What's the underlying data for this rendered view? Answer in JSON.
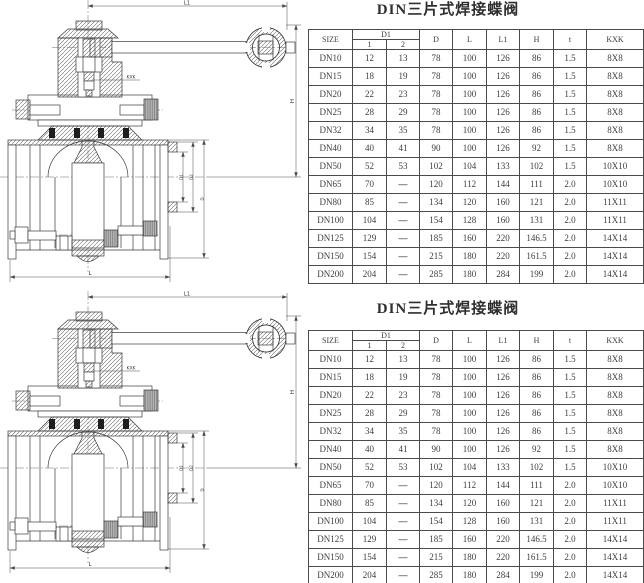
{
  "page": {
    "title_top": "DIN三片式焊接蝶阀",
    "title_bottom": "DIN三片式焊接蝶阀"
  },
  "table": {
    "headers": {
      "size": "SIZE",
      "d1": "D1",
      "d1_sub1": "1",
      "d1_sub2": "2",
      "d": "D",
      "l": "L",
      "l1": "L1",
      "h": "H",
      "t": "t",
      "kxk": "KXK"
    },
    "rows": [
      [
        "DN10",
        "12",
        "13",
        "78",
        "100",
        "126",
        "86",
        "1.5",
        "8X8"
      ],
      [
        "DN15",
        "18",
        "19",
        "78",
        "100",
        "126",
        "86",
        "1.5",
        "8X8"
      ],
      [
        "DN20",
        "22",
        "23",
        "78",
        "100",
        "126",
        "86",
        "1.5",
        "8X8"
      ],
      [
        "DN25",
        "28",
        "29",
        "78",
        "100",
        "126",
        "86",
        "1.5",
        "8X8"
      ],
      [
        "DN32",
        "34",
        "35",
        "78",
        "100",
        "126",
        "86",
        "1.5",
        "8X8"
      ],
      [
        "DN40",
        "40",
        "41",
        "90",
        "100",
        "126",
        "92",
        "1.5",
        "8X8"
      ],
      [
        "DN50",
        "52",
        "53",
        "102",
        "104",
        "133",
        "102",
        "1.5",
        "10X10"
      ],
      [
        "DN65",
        "70",
        "—",
        "120",
        "112",
        "144",
        "111",
        "2.0",
        "10X10"
      ],
      [
        "DN80",
        "85",
        "—",
        "134",
        "120",
        "160",
        "121",
        "2.0",
        "11X11"
      ],
      [
        "DN100",
        "104",
        "—",
        "154",
        "128",
        "160",
        "131",
        "2.0",
        "11X11"
      ],
      [
        "DN125",
        "129",
        "—",
        "185",
        "160",
        "220",
        "146.5",
        "2.0",
        "14X14"
      ],
      [
        "DN150",
        "154",
        "—",
        "215",
        "180",
        "220",
        "161.5",
        "2.0",
        "14X14"
      ],
      [
        "DN200",
        "204",
        "—",
        "285",
        "180",
        "284",
        "199",
        "2.0",
        "14X14"
      ]
    ]
  },
  "drawing": {
    "dims": {
      "l1": "L1",
      "h": "H",
      "l": "L",
      "kxk": "KXK",
      "d1": "D1",
      "d2": "D2",
      "d": "D"
    }
  },
  "colors": {
    "line": "#3a3a3a",
    "dim_line": "#4a4a4a",
    "seal": "#1e1e1e",
    "knurl_fill": "#b5b5b5"
  }
}
